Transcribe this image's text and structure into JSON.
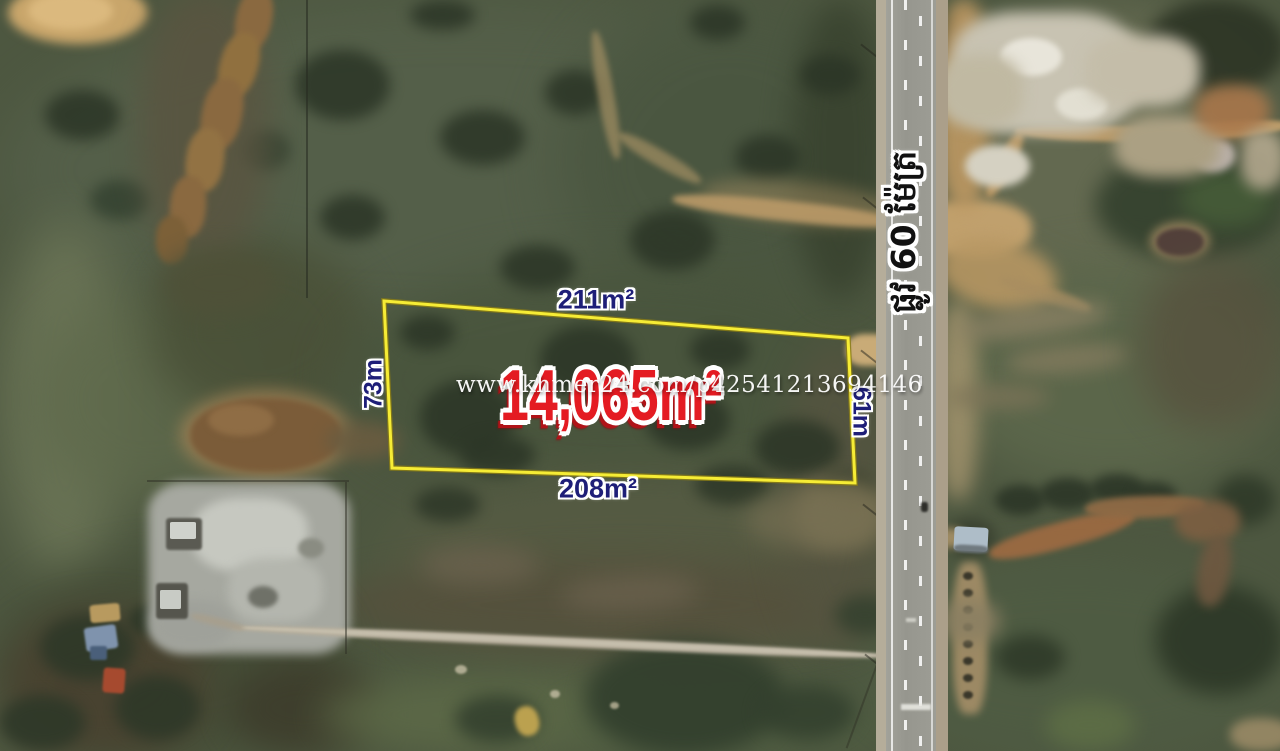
{
  "listing_map": {
    "watermark": "www.khmer24.com/p42541213694146",
    "plot": {
      "area_label": "14,065m²",
      "top_side_label": "211m²",
      "bottom_side_label": "208m²",
      "left_side_label": "73m",
      "right_side_label": "61m"
    },
    "road_label": "ផ្លូវ 60 ម៉ែត្រ",
    "colors": {
      "plot_outline": "#f6ec35",
      "area_label_text": "#e41b22",
      "side_label_text": "#1e1e78",
      "road_label_text": "#111111",
      "watermark_text": "#ffffff"
    }
  }
}
